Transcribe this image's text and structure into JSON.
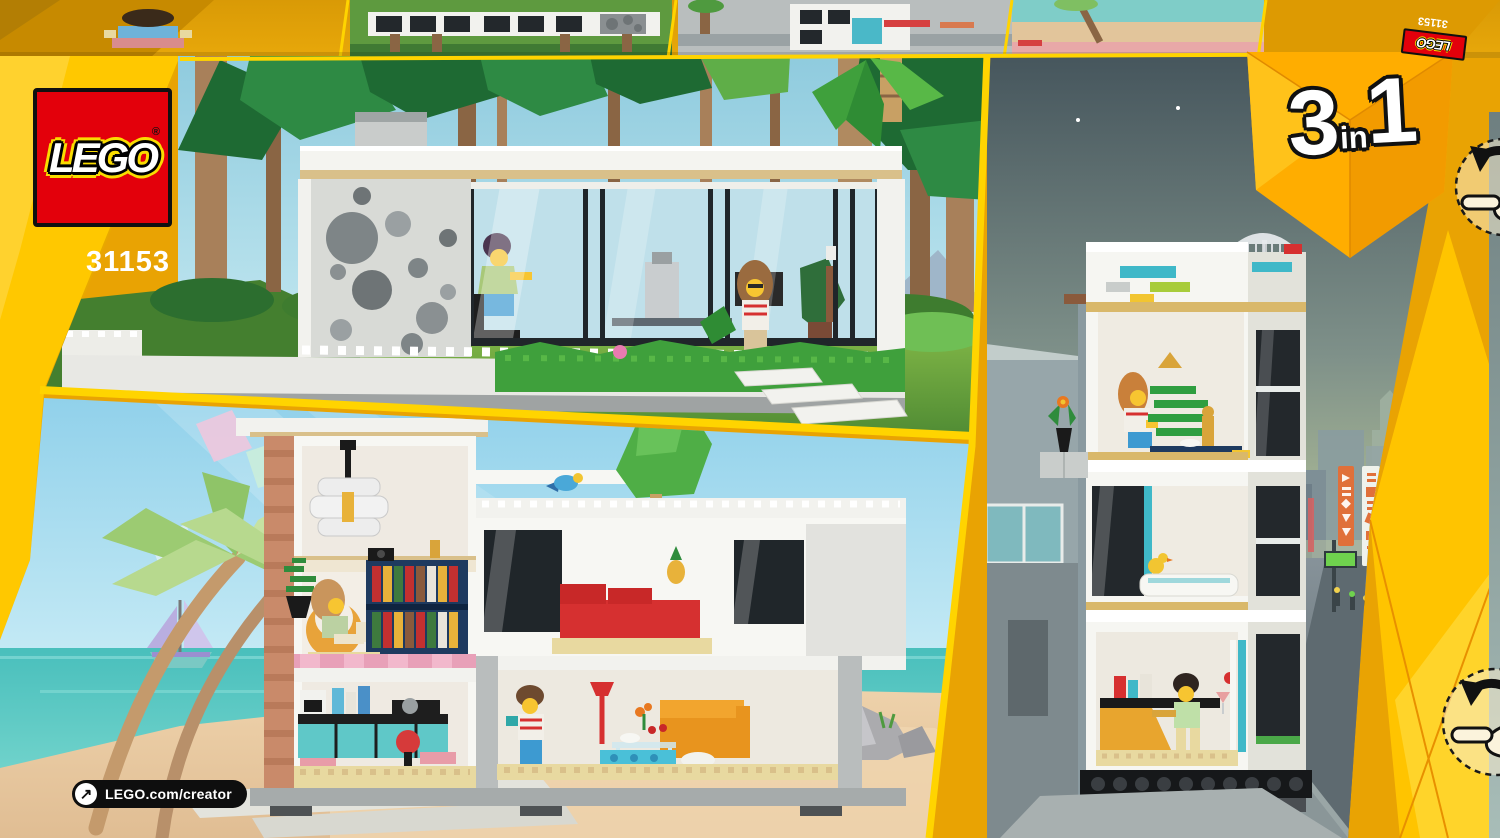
{
  "brand": {
    "logo_text": "LEGO",
    "registered_mark": "®"
  },
  "set": {
    "number": "31153"
  },
  "badge": {
    "digit_left": "3",
    "word": "in",
    "digit_right": "1"
  },
  "footer": {
    "url": "LEGO.com/creator",
    "link_arrow_glyph": "↗"
  },
  "icons": {
    "rotate_model": "rotate-hand-icon",
    "link_arrow": "arrow-up-right-icon"
  },
  "colors": {
    "lego_red": "#E3000B",
    "bright_yellow": "#FFCB00",
    "box_gold": "#E9A303",
    "badge_gold": "#FFAD00",
    "day_sky": "#97CEDF",
    "beach_sky": "#A9DCF1",
    "sea_teal": "#49BFBC",
    "sand": "#E8CBA4",
    "grass_green": "#5FA43C",
    "night_sky": "#46565D",
    "pill_black": "#0E0E0E"
  }
}
